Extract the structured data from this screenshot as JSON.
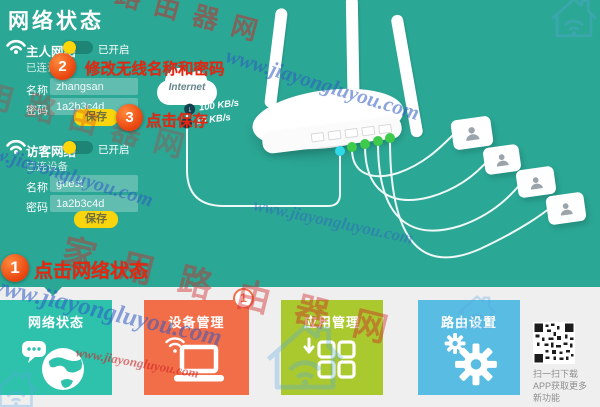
{
  "page": {
    "title": "网络状态"
  },
  "watermark": {
    "site": "家用路由器网",
    "url": "www.jiayongluyou.com"
  },
  "networks": {
    "main": {
      "label": "主人网络",
      "status": "已开启",
      "devices_label": "已连设备",
      "name_label": "名称",
      "name_value": "zhangsan",
      "password_label": "密码",
      "password_value": "1a2b3c4d",
      "save_label": "保存"
    },
    "guest": {
      "label": "访客网络",
      "status": "已开启",
      "devices_label": "已连设备",
      "name_label": "名称",
      "name_value": "guest",
      "password_label": "密码",
      "password_value": "1a2b3c4d",
      "save_label": "保存"
    }
  },
  "annotations": {
    "step1": {
      "num": "1",
      "text": "点击网络状态"
    },
    "step2": {
      "num": "2",
      "text": "修改无线名称和密码"
    },
    "step3": {
      "num": "3",
      "text": "点击保存"
    }
  },
  "diagram": {
    "internet_label": "Internet",
    "download_speed": "100 KB/s",
    "upload_speed": "10 KB/s"
  },
  "tiles": [
    {
      "label": "网络状态"
    },
    {
      "label": "设备管理",
      "badge": "1"
    },
    {
      "label": "应用管理"
    },
    {
      "label": "路由设置"
    }
  ],
  "qr": {
    "line1": "扫一扫下载",
    "line2": "APP获取更多",
    "line3": "新功能"
  },
  "colors": {
    "background": "#2ba795",
    "tile_network": "#2ec2ad",
    "tile_device": "#f26e49",
    "tile_app": "#a9c92f",
    "tile_router": "#58bce3",
    "save_button": "#f8d50c",
    "annotation_red": "#e8250f",
    "badge_orange": "#e8430e",
    "wan_dot": "#2fd9ea",
    "lan_dot": "#3ecb4b"
  }
}
